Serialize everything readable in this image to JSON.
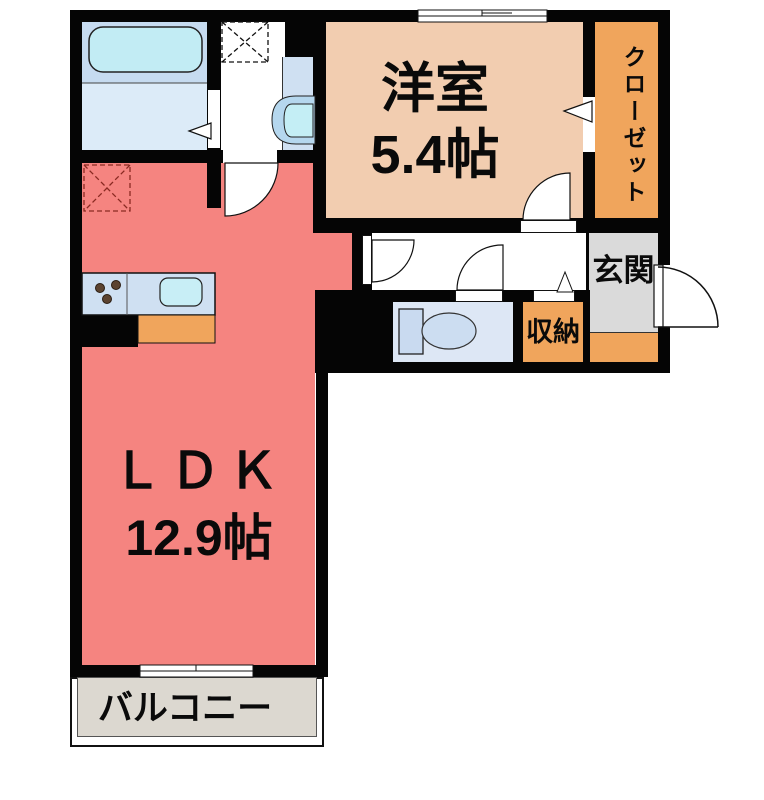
{
  "rooms": {
    "western_room": {
      "name": "洋室",
      "area": "5.4帖"
    },
    "ldk": {
      "name": "ＬＤＫ",
      "area": "12.9帖"
    },
    "closet": {
      "name": "クローゼット"
    },
    "entrance": {
      "name": "玄関"
    },
    "storage": {
      "name": "収納"
    },
    "balcony": {
      "name": "バルコニー"
    }
  },
  "fixtures": [
    "bathtub",
    "washing-machine-space",
    "washbasin",
    "toilet",
    "kitchen-counter",
    "kitchen-sink",
    "stove-burners",
    "refrigerator-space"
  ],
  "colors": {
    "ldk": "#f58480",
    "western_room": "#f2cdb0",
    "closet_storage_orange": "#f0a55c",
    "entrance_gray": "#dadada",
    "balcony_floor": "#dcd8d0",
    "bathroom_upper": "#c6dbf0",
    "bathroom_lower": "#dcebf8",
    "fixture_blue": "#cfe0f2",
    "tub_cyan": "#c2ecf4",
    "wall_black": "#050505"
  }
}
